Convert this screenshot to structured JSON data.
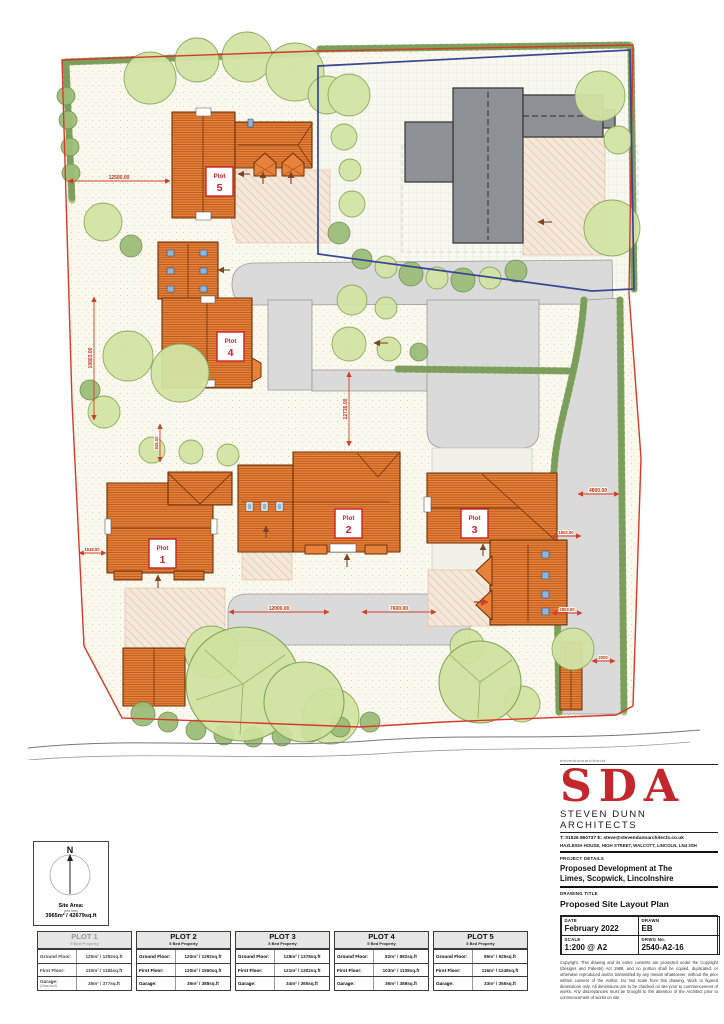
{
  "plan": {
    "plot_labels": [
      {
        "word": "Plot",
        "num": "1"
      },
      {
        "word": "Plot",
        "num": "2"
      },
      {
        "word": "Plot",
        "num": "3"
      },
      {
        "word": "Plot",
        "num": "4"
      },
      {
        "word": "Plot",
        "num": "5"
      }
    ],
    "dimensions": {
      "d12500": "12500.00",
      "d10803": "10803.00",
      "d845": "845.00",
      "d1518": "1518.00",
      "d12735": "12735.00",
      "d12000": "12000.00",
      "d7600": "7600.00",
      "d4800": "4800.00",
      "d1803": "1803.00",
      "d2803": "2803.00",
      "d2000": "2000"
    }
  },
  "north_box": {
    "letter": "N",
    "site_area_label": "Site Area:",
    "site_area_sub": "(red line)",
    "site_area_value": "3965m² / 42679sq.ft"
  },
  "title_block": {
    "micro_header": "stevendunnarchitects",
    "logo": "SDA",
    "firm": "STEVEN DUNN ARCHITECTS",
    "contact": "T: 01526 860737   E: steve@stevendunnarchitects.co.uk",
    "address": "HAZLEIGH HOUSE, HIGH STREET, WALCOTT, LINCOLN, LN4 3SH",
    "project_details_label": "PROJECT DETAILS",
    "project_details": "Proposed Development at The Limes, Scopwick, Lincolnshire",
    "drawing_title_label": "DRAWING TITLE",
    "drawing_title": "Proposed Site Layout Plan",
    "date_label": "DATE",
    "date": "February 2022",
    "drawn_label": "DRAWN",
    "drawn": "EB",
    "scale_label": "SCALE",
    "scale": "1:200 @ A2",
    "drwg_label": "DRWG No.",
    "drwg_no": "2540-A2-16",
    "copyright": "Copyright. This drawing and its entire contents are protected under the Copyright (Designs and Patents) Act 1988, and no portion shall be copied, duplicated, or otherwise reproduced and/or transmitted by any means whatsoever, without the prior written consent of the Author. Do Not scale from this drawing. Work to figured dimensions only. All dimensions are to be checked on site prior to commencement of works. Any discrepancies must be brought to the attention of the Architect prior to commencement of works on site."
  },
  "plot_tables": [
    {
      "title": "PLOT 1",
      "subtitle": "5 Bed Property",
      "garage_note": "(Detached)",
      "rows": [
        [
          "Ground Floor:",
          "120m² / 1292sq.ft"
        ],
        [
          "First Floor:",
          "110m² / 1184sq.ft"
        ],
        [
          "Garage:",
          "35m² / 377sq.ft"
        ]
      ]
    },
    {
      "title": "PLOT 2",
      "subtitle": "5 Bed Property",
      "rows": [
        [
          "Ground Floor:",
          "120m² / 1292sq.ft"
        ],
        [
          "First Floor:",
          "120m² / 1550sq.ft"
        ],
        [
          "Garage:",
          "36m² / 388sq.ft"
        ]
      ]
    },
    {
      "title": "PLOT 3",
      "subtitle": "5 Bed Property",
      "rows": [
        [
          "Ground Floor:",
          "128m² / 1378sq.ft"
        ],
        [
          "First Floor:",
          "121m² / 1302sq.ft"
        ],
        [
          "Garage:",
          "34m² / 365sq.ft"
        ]
      ]
    },
    {
      "title": "PLOT 4",
      "subtitle": "5 Bed Property",
      "rows": [
        [
          "Ground Floor:",
          "82m² / 882sq.ft"
        ],
        [
          "First Floor:",
          "103m² / 1108sq.ft"
        ],
        [
          "Garage:",
          "36m² / 388sq.ft"
        ]
      ]
    },
    {
      "title": "PLOT 5",
      "subtitle": "5 Bed Property",
      "rows": [
        [
          "Ground Floor:",
          "86m² / 925sq.ft"
        ],
        [
          "First Floor:",
          "116m² / 1248sq.ft"
        ],
        [
          "Garage:",
          "33m² / 355sq.ft"
        ]
      ]
    }
  ]
}
